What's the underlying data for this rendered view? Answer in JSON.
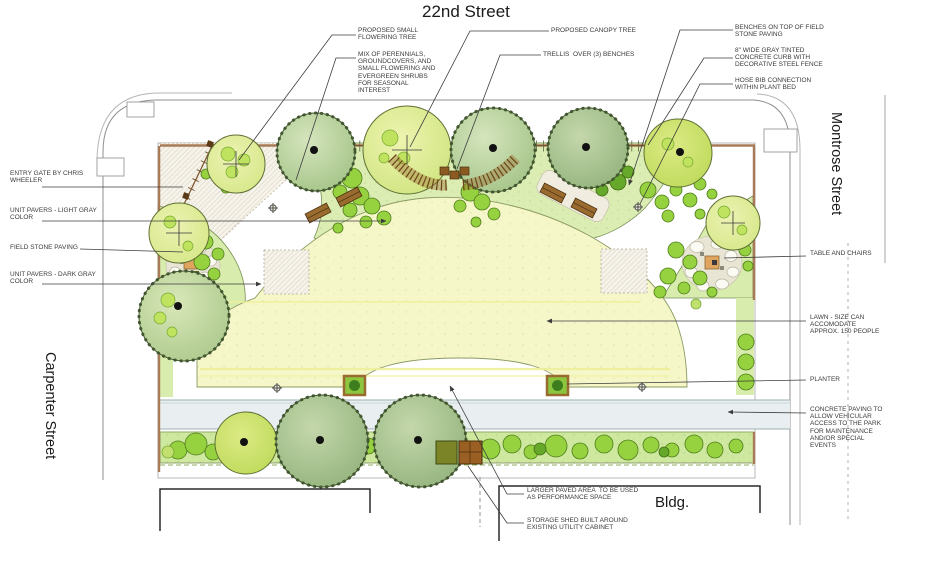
{
  "streets": {
    "top": "22nd Street",
    "right": "Montrose Street",
    "left": "Carpenter Street",
    "building": "Bldg."
  },
  "callouts": [
    {
      "id": "proposed-small-flowering-tree",
      "text": "PROPOSED SMALL\nFLOWERING TREE"
    },
    {
      "id": "perennials-mix",
      "text": "MIX OF PERENNIALS,\nGROUNDCOVERS, AND\nSMALL FLOWERING AND\nEVERGREEN SHRUBS\nFOR SEASONAL\nINTEREST"
    },
    {
      "id": "proposed-canopy-tree",
      "text": "PROPOSED CANOPY TREE"
    },
    {
      "id": "trellis-benches",
      "text": "TRELLIS  OVER (3) BENCHES"
    },
    {
      "id": "benches-field-stone",
      "text": "BENCHES ON TOP OF FIELD\nSTONE PAVING"
    },
    {
      "id": "concrete-curb-fence",
      "text": "8\" WIDE GRAY TINTED\nCONCRETE CURB WITH\nDECORATIVE STEEL FENCE"
    },
    {
      "id": "hose-bib",
      "text": "HOSE BIB CONNECTION\nWITHIN PLANT BED"
    },
    {
      "id": "entry-gate",
      "text": "ENTRY GATE BY CHRIS\nWHEELER"
    },
    {
      "id": "unit-pavers-light",
      "text": "UNIT PAVERS - LIGHT GRAY\nCOLOR"
    },
    {
      "id": "field-stone-paving",
      "text": "FIELD STONE PAVING"
    },
    {
      "id": "unit-pavers-dark",
      "text": "UNIT PAVERS - DARK GRAY\nCOLOR"
    },
    {
      "id": "table-chairs",
      "text": "TABLE AND CHAIRS"
    },
    {
      "id": "lawn",
      "text": "LAWN - SIZE CAN\nACCOMODATE\nAPPROX. 150 PEOPLE"
    },
    {
      "id": "planter",
      "text": "PLANTER"
    },
    {
      "id": "concrete-paving",
      "text": "CONCRETE PAVING TO\nALLOW VEHICULAR\nACCESS TO THE PARK\nFOR MAINTENANCE\nAND/OR SPECIAL\nEVENTS"
    },
    {
      "id": "performance-space",
      "text": "LARGER PAVED AREA  TO BE USED\nAS PERFORMANCE SPACE"
    },
    {
      "id": "storage-shed",
      "text": "STORAGE SHED BUILT AROUND\nEXISTING UTILITY CABINET"
    }
  ],
  "colors": {
    "lawn": "#f5f7c9",
    "planting_bed": "#dcedb4",
    "shrub_green": "#96d23f",
    "canopy_sage": "#a8c78e",
    "bench_brown": "#9a6b2f",
    "curb_brown": "#a87a58",
    "concrete": "#e9eef0",
    "paver_hatch": "#cfc7b4",
    "leader_line": "#3c3c3c"
  }
}
